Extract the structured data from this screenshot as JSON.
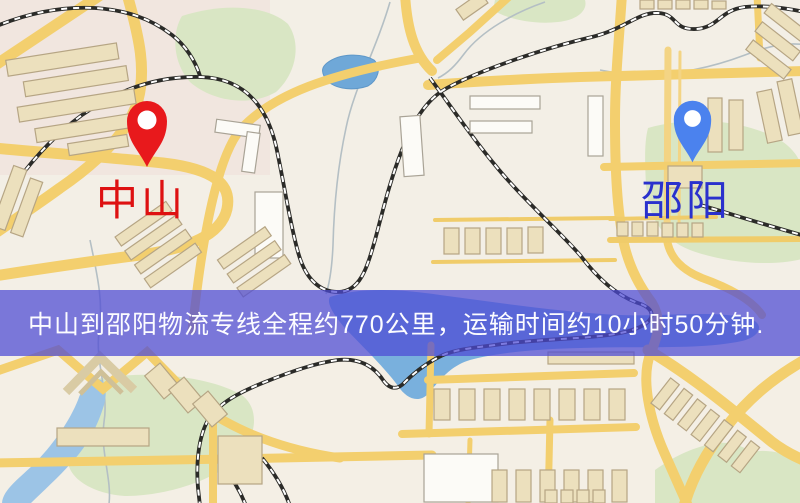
{
  "banner": {
    "text": "中山到邵阳物流专线全程约770公里，运输时间约10小时50分钟.",
    "background_color": "#4d4ad5",
    "text_color": "#fcfcff"
  },
  "markers": {
    "origin": {
      "label": "中山",
      "pin_color": "#e8191c",
      "label_color": "#de1111"
    },
    "destination": {
      "label": "邵阳",
      "pin_color": "#4b82ee",
      "label_color": "#2a31cd"
    }
  },
  "map_colors": {
    "land": "#f3efe6",
    "land_tint": "#f0dcd8",
    "park": "#d9e6c4",
    "water": "#79b0dd",
    "lake": "#6fa8d8",
    "road": "#f3cf6e",
    "railway": "#2b2b28",
    "building_tan": "#ece0bd",
    "building_white": "#fcfbf7"
  }
}
